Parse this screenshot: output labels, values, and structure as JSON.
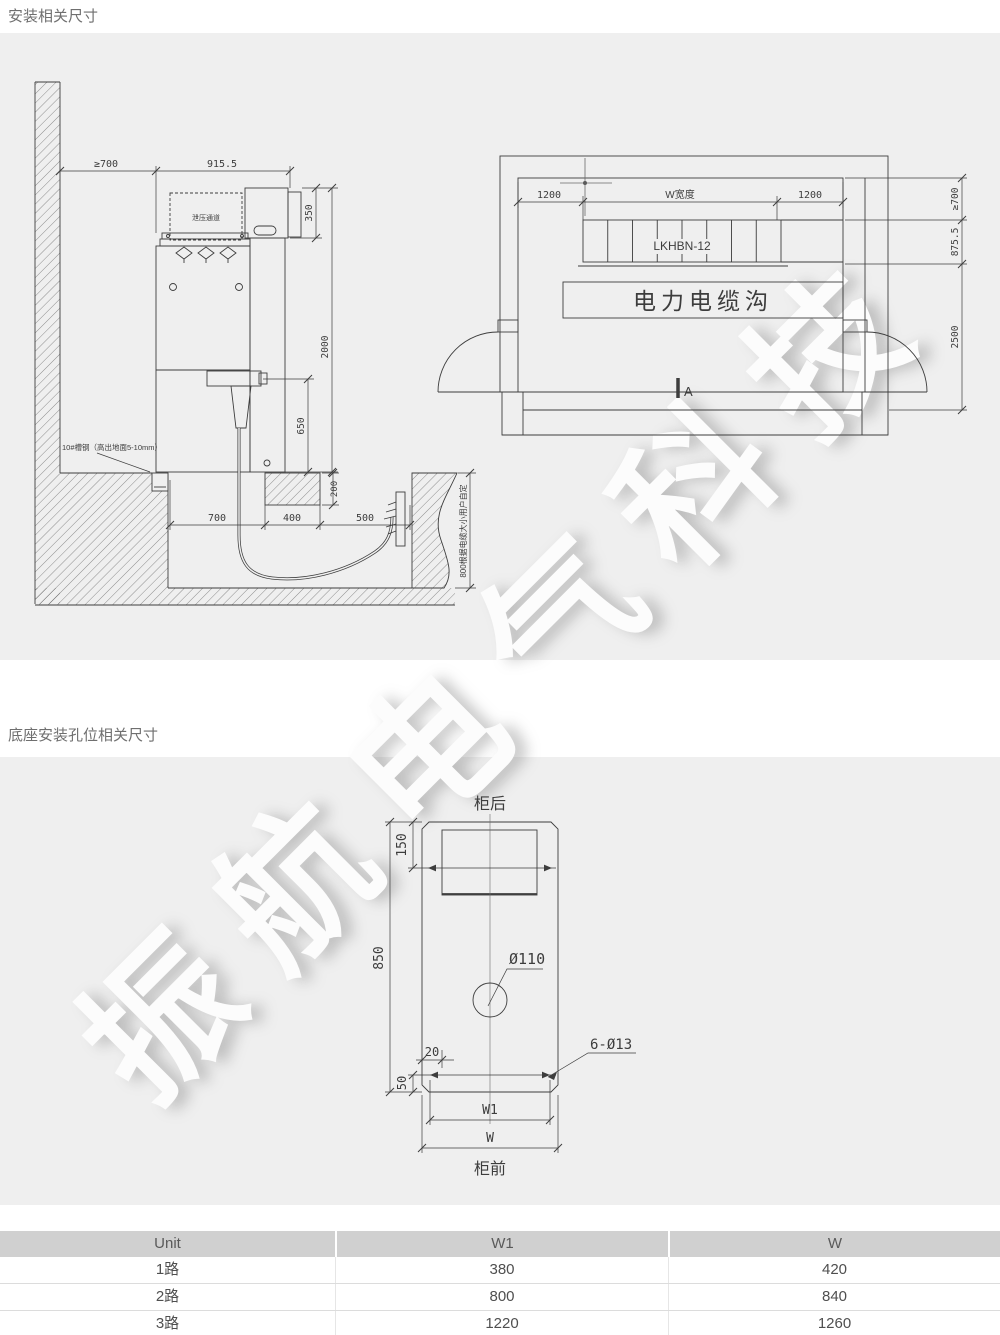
{
  "titles": {
    "install": "安装相关尺寸",
    "base": "底座安装孔位相关尺寸"
  },
  "watermark": "振航电气科技",
  "side": {
    "clear": "≥700",
    "depth": "915.5",
    "box350": "350",
    "h2000": "2000",
    "h650": "650",
    "d200": "200",
    "w700": "700",
    "w400": "400",
    "w500": "500",
    "note800": "800根据电缆大小用户自定",
    "noteChannel": "10#槽钢（高出地面5-10mm）",
    "duct": "泄压通道"
  },
  "plan": {
    "c1200L": "1200",
    "wLabel": "W宽度",
    "c1200R": "1200",
    "c700": "≥700",
    "d875": "875.5",
    "d2500": "2500",
    "model": "LKHBN-12",
    "trench": "电力电缆沟",
    "secA": "A"
  },
  "base": {
    "rear": "柜后",
    "front": "柜前",
    "d150": "150",
    "d850": "850",
    "hole": "Ø110",
    "d20": "20",
    "holes6": "6-Ø13",
    "d50": "50",
    "w1": "W1",
    "w": "W"
  },
  "table": {
    "headers": [
      "Unit",
      "W1",
      "W"
    ],
    "rows": [
      [
        "1路",
        "380",
        "420"
      ],
      [
        "2路",
        "800",
        "840"
      ],
      [
        "3路",
        "1220",
        "1260"
      ]
    ]
  }
}
